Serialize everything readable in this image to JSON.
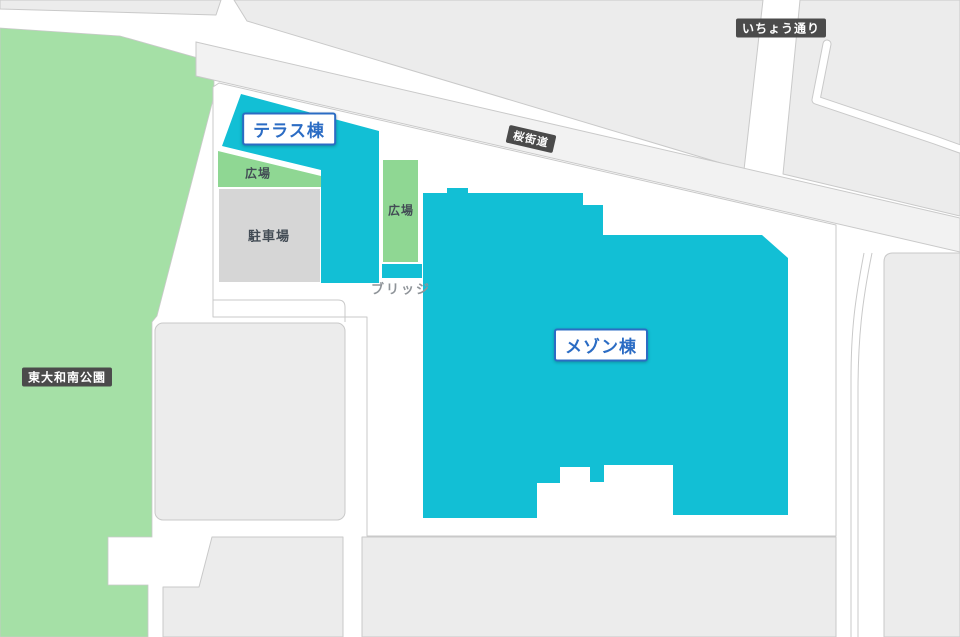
{
  "map": {
    "title": "site map",
    "labels": {
      "park": "東大和南公園",
      "terrace_building": "テラス棟",
      "maison_building": "メゾン棟",
      "plaza": "広場",
      "parking": "駐車場",
      "bridge": "ブリッジ",
      "road_sakura": "桜街道",
      "road_icho": "いちょう通り"
    }
  },
  "colors": {
    "building": "#12BFD5",
    "park": "#A5E0A6",
    "plaza": "#8FD793",
    "parking": "#D6D6D6",
    "block": "#ECECEC",
    "block_stroke": "#C9C9C9",
    "road": "#F2F2F2",
    "badge_blue": "#2B6CC4",
    "badge_dark": "#4B4B4B",
    "area_text": "#434C55",
    "bridge_text": "#8F9499"
  }
}
